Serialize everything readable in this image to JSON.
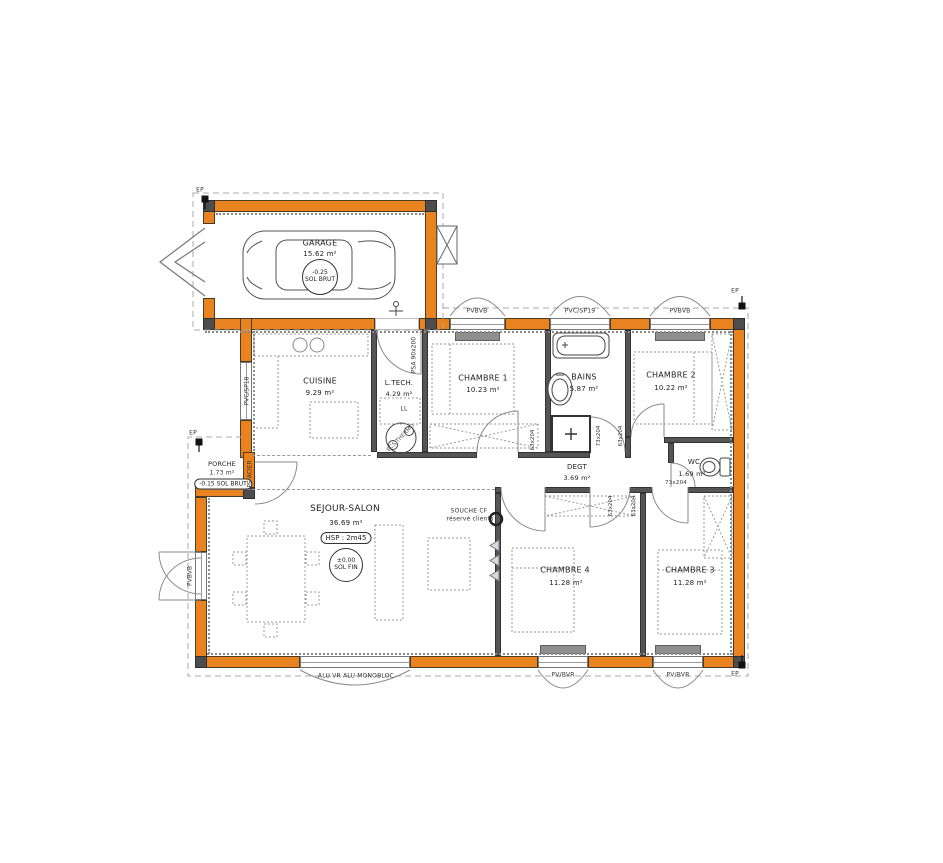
{
  "colors": {
    "wall_orange": "#e8831f",
    "line": "#4a4a4a",
    "dash": "#9a9a9a"
  },
  "rooms": {
    "garage": {
      "name": "GARAGE",
      "area": "15.62 m²",
      "level": "-0.25",
      "level_sub": "SOL BRUT"
    },
    "cuisine": {
      "name": "CUISINE",
      "area": "9.29 m²"
    },
    "ltech": {
      "name": "L.TECH.",
      "area": "4.29 m²"
    },
    "chambre1": {
      "name": "CHAMBRE 1",
      "area": "10.23 m²"
    },
    "bains": {
      "name": "BAINS",
      "area": "5.87 m²"
    },
    "chambre2": {
      "name": "CHAMBRE 2",
      "area": "10.22 m²"
    },
    "degt": {
      "name": "DEGT",
      "area": "3.69 m²"
    },
    "wc": {
      "name": "WC",
      "area": "1.69 m²"
    },
    "sejour": {
      "name": "SEJOUR-SALON",
      "area": "36.69 m²",
      "ceiling_height": "HSP : 2m45",
      "level": "±0.00",
      "level_sub": "SOL FIN"
    },
    "chambre4": {
      "name": "CHAMBRE 4",
      "area": "11.28 m²"
    },
    "chambre3": {
      "name": "CHAMBRE 3",
      "area": "11.28 m²"
    },
    "porche": {
      "name": "PORCHE",
      "area": "1.73 m²",
      "level": "-0.15 SOL BRUT"
    }
  },
  "openings": {
    "window_pvbvb": "PVBVB",
    "window_pvcsp19": "PVC/SP19",
    "window_pvcsp18": "PVC/SP18",
    "window_pvbvr": "PV/BVR",
    "bay_monobloc": "ALU.VR ALU MONOBLOC",
    "entry_door": "PE ACIER",
    "service_door": "PSA 90x200",
    "door_63": "63x204",
    "door_73": "73x204"
  },
  "annotations": {
    "ep": "EP",
    "souche_l1": "SOUCHE CF",
    "souche_l2": "réservé clients",
    "washer": "LL",
    "heater": "ECS THERMO"
  }
}
